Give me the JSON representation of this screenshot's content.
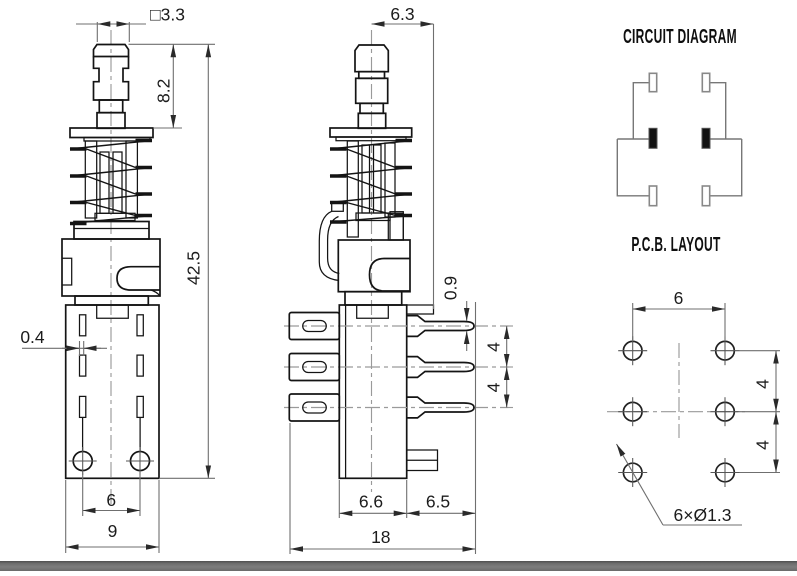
{
  "front_view": {
    "dim_cap_square": "□3.3",
    "dim_plunger_height": "8.2",
    "dim_total_height": "42.5",
    "dim_terminal_width": "0.4",
    "dim_peg_pitch": "6",
    "dim_body_width": "9"
  },
  "side_view": {
    "dim_cap_width": "6.3",
    "dim_pin_thickness": "0.9",
    "dim_pin_pitch_top": "4",
    "dim_pin_pitch_bottom": "4",
    "dim_body_depth": "6.6",
    "dim_pin_length": "6.5",
    "dim_overall_depth": "18"
  },
  "circuit_diagram": {
    "title": "CIRCUIT DIAGRAM"
  },
  "pcb_layout": {
    "title": "P.C.B. LAYOUT",
    "dim_column_pitch": "6",
    "dim_row_pitch_top": "4",
    "dim_row_pitch_bottom": "4",
    "hole_callout": "6×Ø1.3"
  }
}
